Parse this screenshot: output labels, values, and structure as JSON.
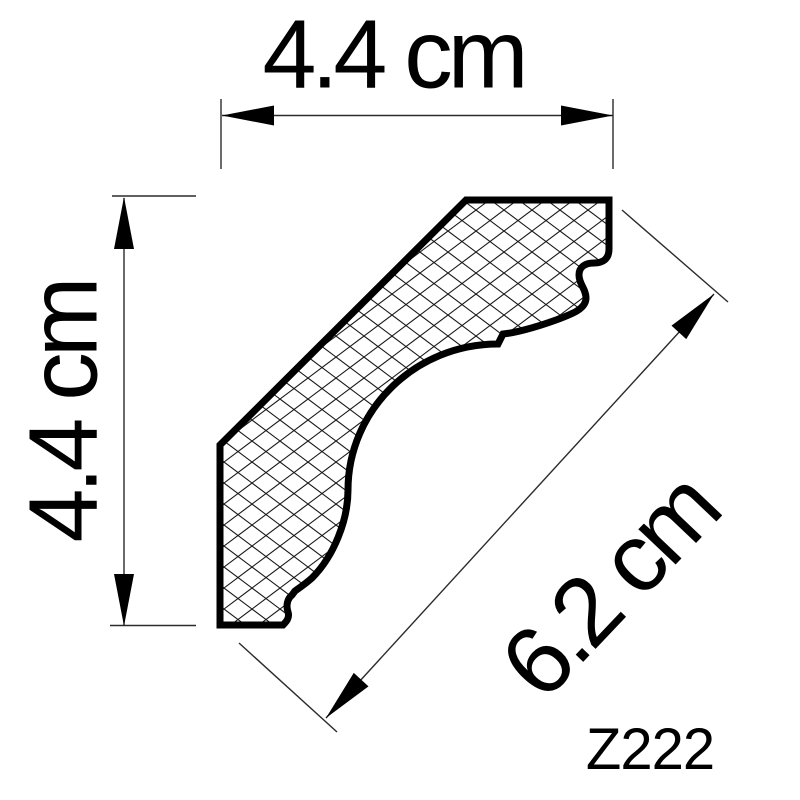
{
  "drawing": {
    "type": "technical-profile-drawing",
    "subject": "crown-molding-cross-section",
    "product_code": "Z222",
    "dimensions": {
      "top": {
        "label": "4.4 cm",
        "value_cm": 4.4
      },
      "left": {
        "label": "4.4 cm",
        "value_cm": 4.4
      },
      "diagonal": {
        "label": "6.2 cm",
        "value_cm": 6.2
      }
    },
    "colors": {
      "ink": "#000000",
      "thin_line": "#2b2b2b",
      "hatch_line": "#1a1a1a",
      "background": "#ffffff"
    }
  }
}
